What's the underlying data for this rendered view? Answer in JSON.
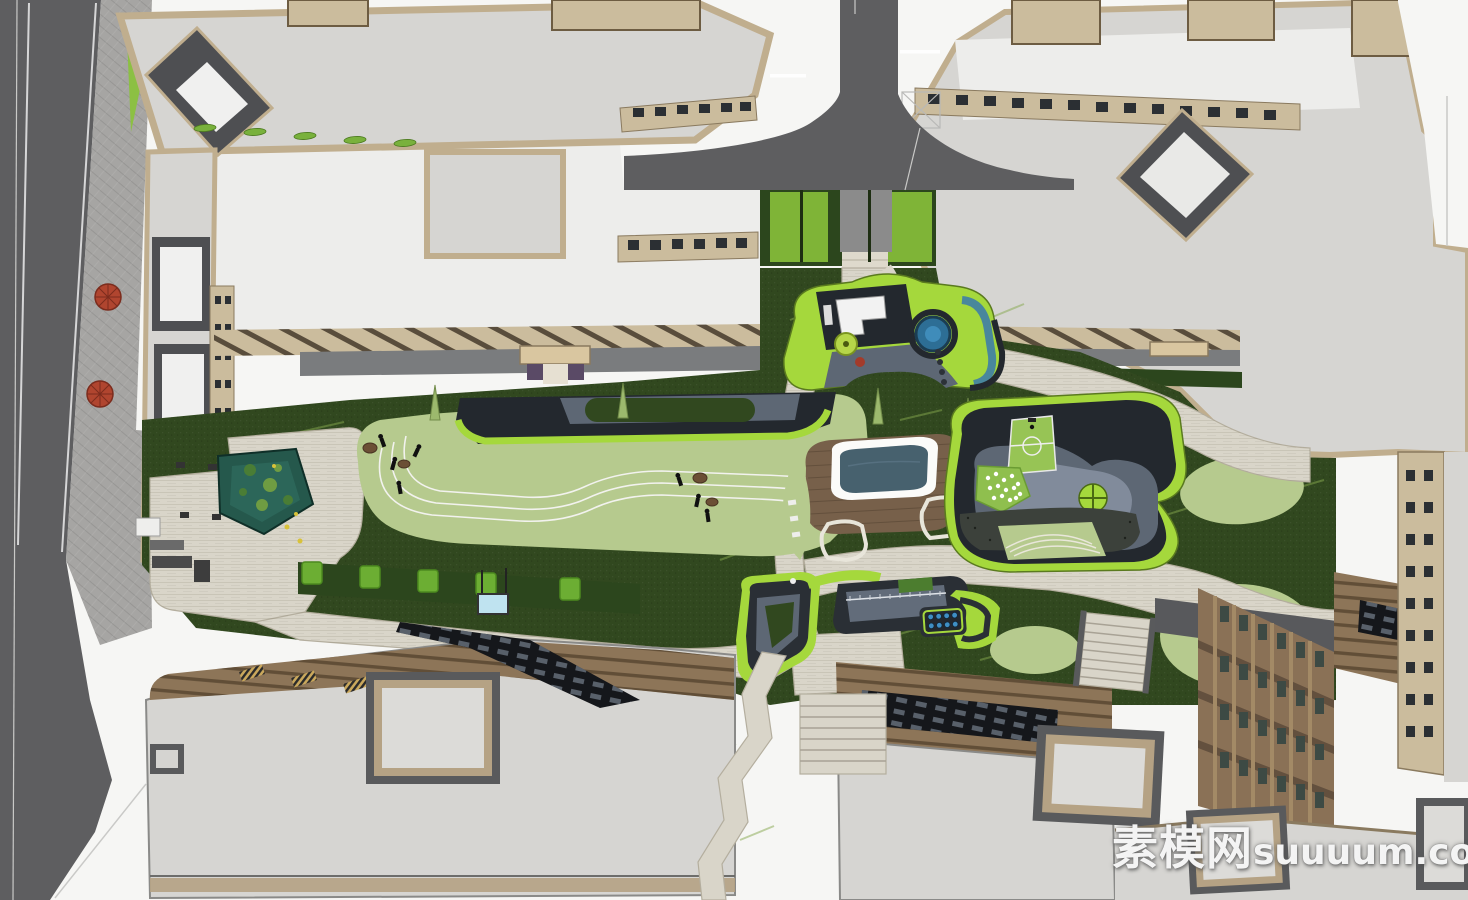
{
  "watermark": {
    "text_cjk": "素模网",
    "text_latin": "suuuum.com",
    "text_full": "素模网suuuum.com"
  },
  "palette": {
    "white_ground": "#f6f6f4",
    "interior": "#ededeb",
    "roof_light": "#d6d5d2",
    "tan": "#c0ae8e",
    "tan_facade": "#cbbc9d",
    "dark_roof": "#4e4f52",
    "gray_wall": "#58595c",
    "road": "#5e5e60",
    "pavement": "#a6a5a3",
    "sidewalk_gray": "#7a7c7e",
    "path": "#d9d5c9",
    "path_edge": "#b4ae9e",
    "lawn": "#31481f",
    "hedge": "#2c461d",
    "bush": "#6cae33",
    "sage": "#b6ca8e",
    "lime": "#a5d83c",
    "charcoal": "#23282e",
    "slate": "#5d6774",
    "slate_light": "#8792a2",
    "deck": "#77604a",
    "pergola": "#8d7558",
    "beam": "#5e4a35",
    "pool_water": "#47616e",
    "pond_water": "#25584c",
    "facade_brown": "#8a7156",
    "umbrella_red": "#b0452f",
    "knob_blue": "#2d6e95",
    "dot_blue": "#3f8fc4",
    "screen_blue": "#bfe3f0",
    "skylight_black": "#15171b",
    "court_green": "#97c455"
  }
}
